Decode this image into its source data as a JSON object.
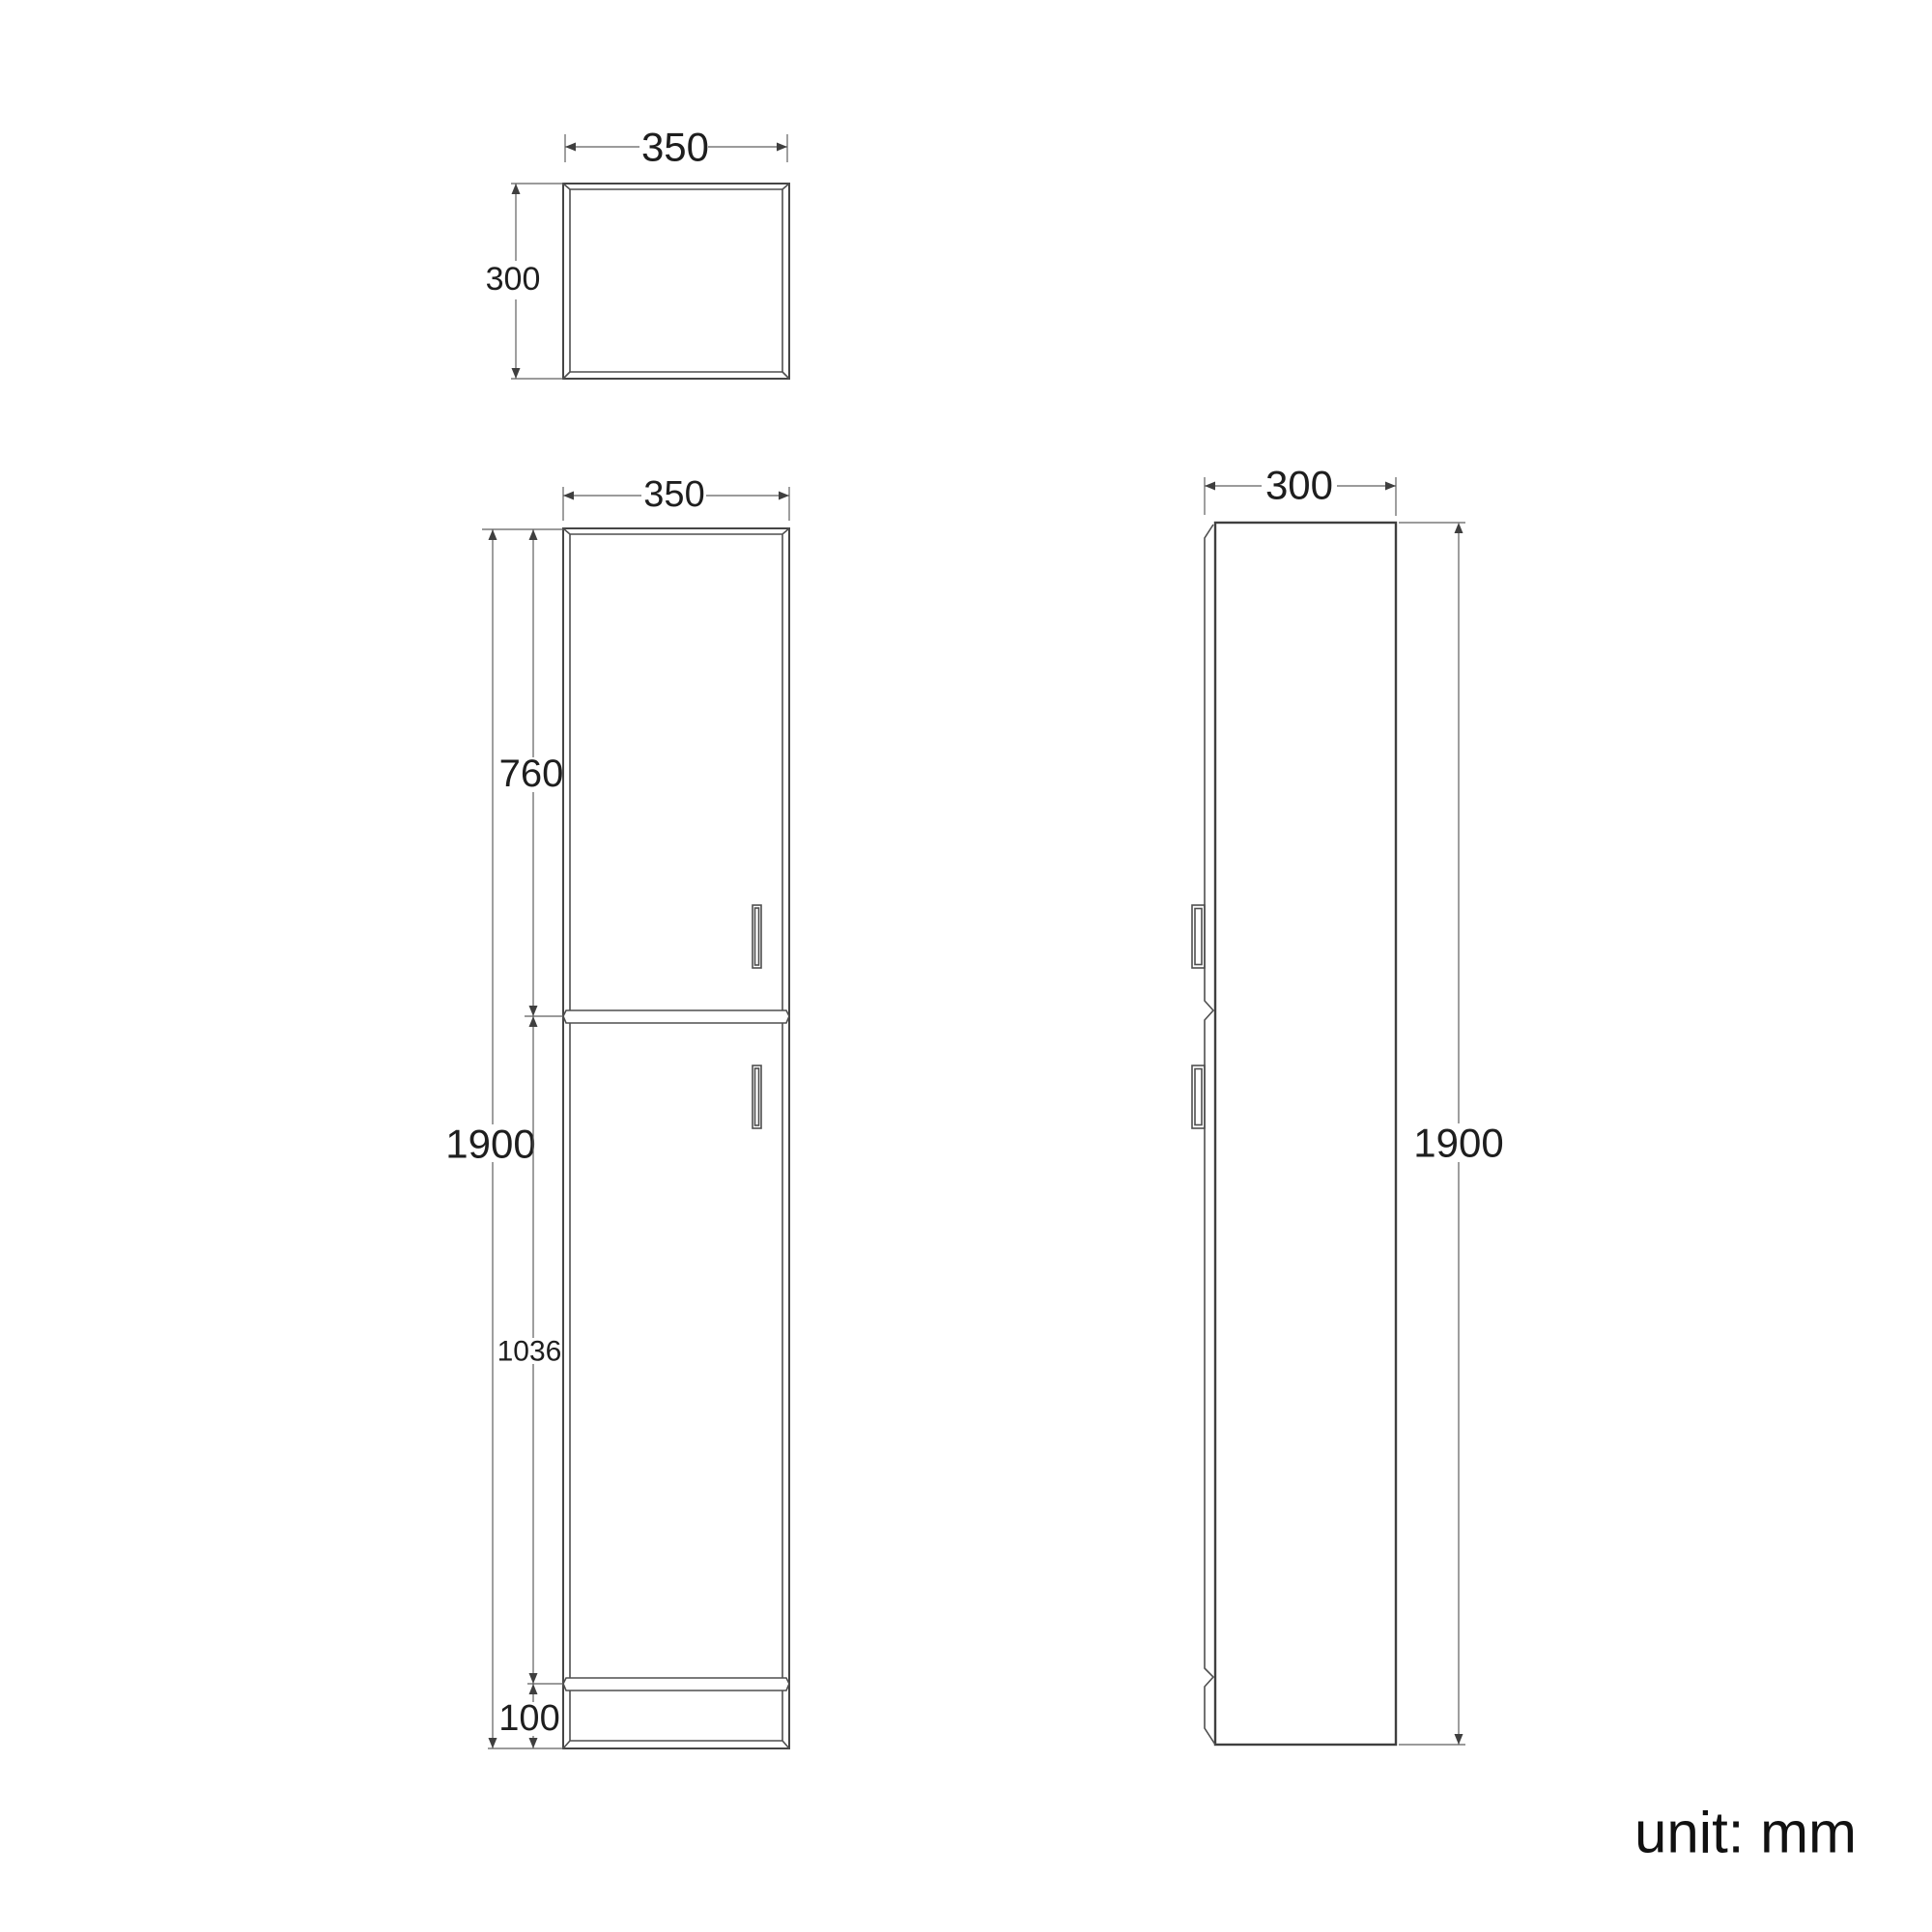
{
  "unit_note": "unit: mm",
  "views": {
    "top": {
      "width": "350",
      "depth": "300"
    },
    "front": {
      "width": "350",
      "height": "1900",
      "upper_door_height": "760",
      "lower_door_height": "1036",
      "plinth_height": "100"
    },
    "side": {
      "depth": "300",
      "height": "1900"
    }
  },
  "colors": {
    "object_line": "#454545",
    "dimension_line": "#5f5f5f",
    "label_text": "#1e1e1e",
    "background": "#ffffff"
  }
}
